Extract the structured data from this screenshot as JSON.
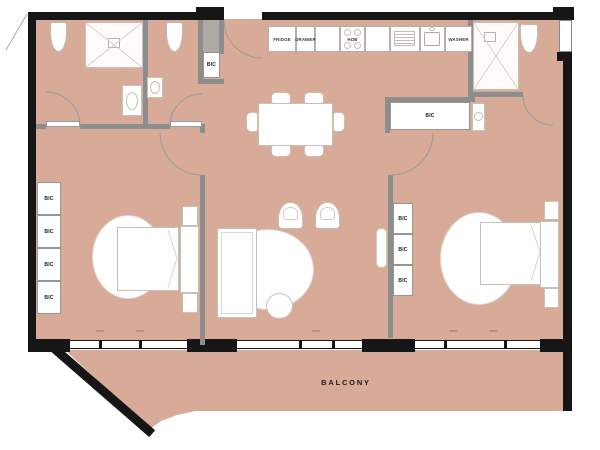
{
  "plan": {
    "balcony": {
      "label": "BALCONY"
    },
    "cabinet_label": "BIC",
    "kitchen": {
      "fridge_label": "FRIDGE",
      "drawer_label": "DRAWER",
      "hob_label": "HOB",
      "washer_label": "WASHER"
    },
    "colors": {
      "floor": "#d7ab97",
      "wall": "#161616",
      "partition": "#8d8d8d",
      "furniture_outline": "#c7bfb8"
    }
  }
}
